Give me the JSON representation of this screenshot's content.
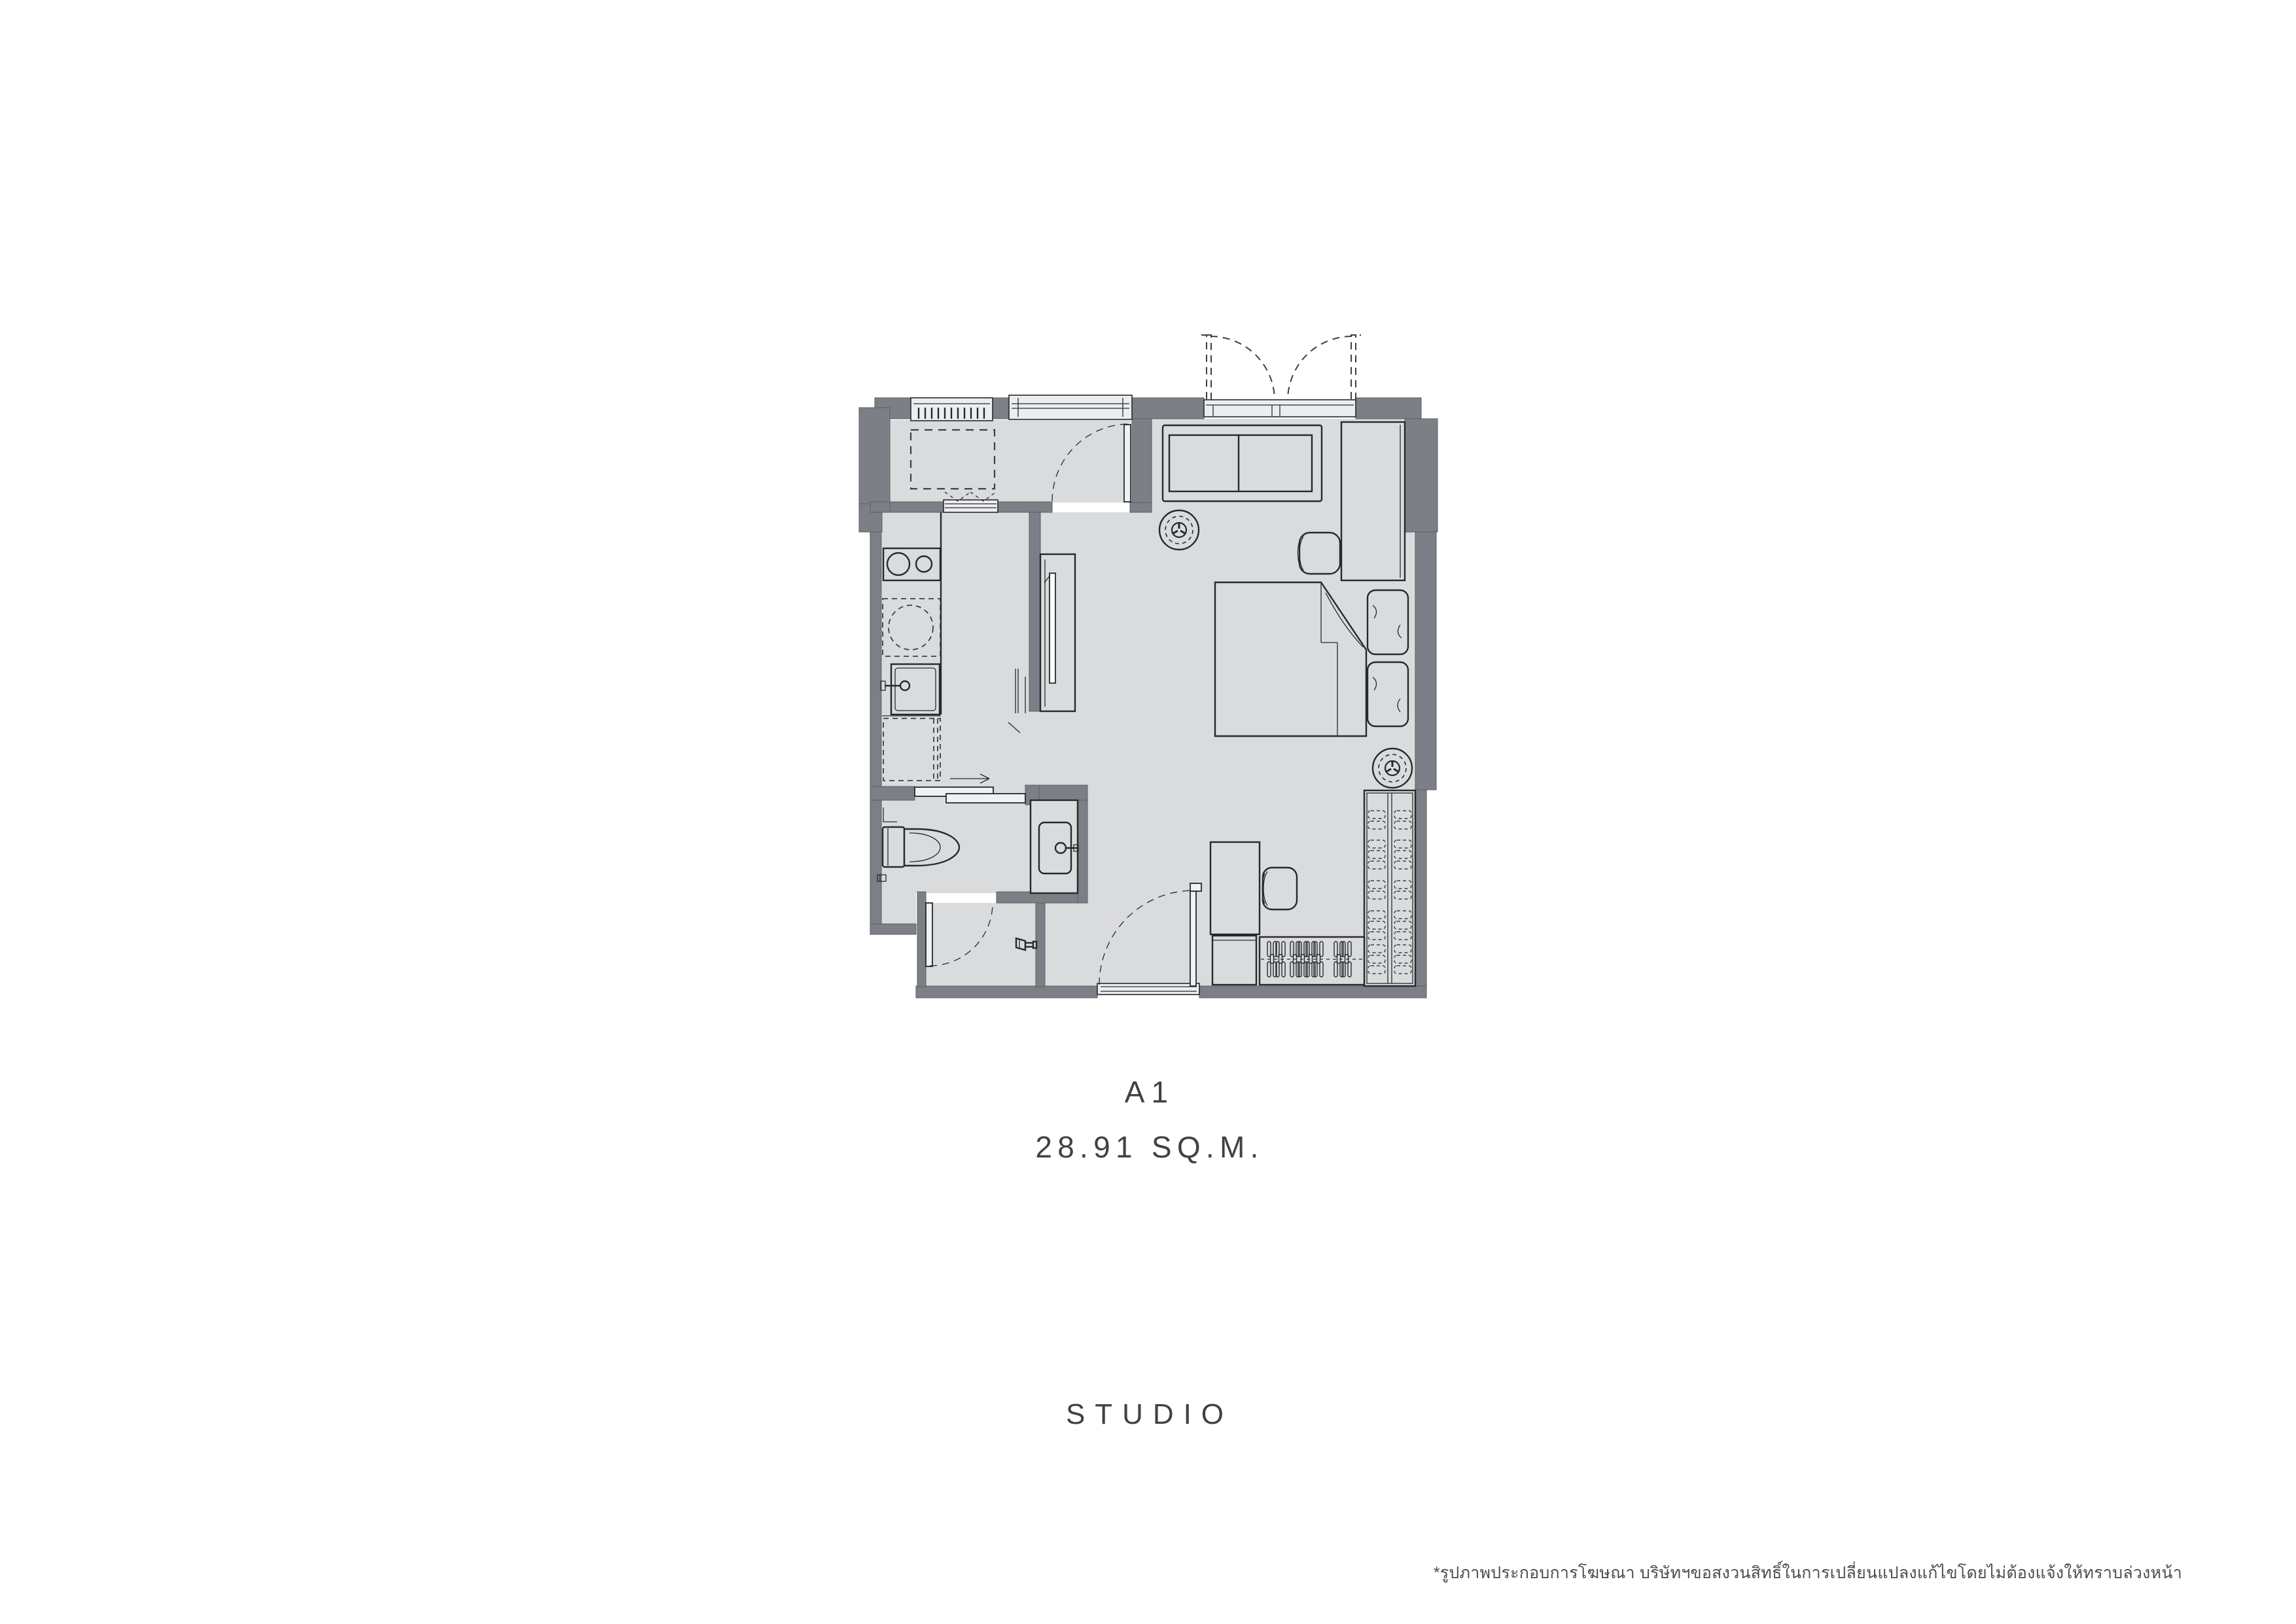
{
  "labels": {
    "unit": "A1",
    "area": "28.91 SQ.M.",
    "type": "STUDIO",
    "disclaimer": "*รูปภาพประกอบการโฆษณา บริษัทฯขอสงวนสิทธิ์ในการเปลี่ยนแปลงแก้ไขโดยไม่ต้องแจ้งให้ทราบล่วงหน้า"
  },
  "colors": {
    "background": "#ffffff",
    "wall": "#7c8086",
    "floor": "#dadbdd",
    "window": "#ecedee",
    "leaf": "#f0f1f2",
    "line": "#26292c",
    "dash": "#3c4043",
    "text": "#3f4245"
  },
  "rooms": [
    "balcony-ac-ledge",
    "living-sleeping-area",
    "kitchen-corridor",
    "bathroom",
    "shower-room",
    "entry-foyer",
    "wardrobe-corner"
  ],
  "fixtures": [
    "ac-condenser-louver-icon",
    "ac-unit-dashed-icon",
    "french-doors-icon",
    "sliding-window-icon",
    "balcony-door-icon",
    "sofa-icon",
    "round-stool-icon",
    "side-cabinet-icon",
    "lounge-chair-icon",
    "double-bed-icon",
    "pillow-icon",
    "tv-cabinet-icon",
    "cooktop-icon",
    "under-counter-washer-icon",
    "kitchen-sink-icon",
    "refrigerator-dashed-icon",
    "bathroom-sliding-door-icon",
    "toilet-icon",
    "vanity-sink-icon",
    "paper-holder-icon",
    "shower-sprayer-icon",
    "entry-door-icon",
    "desk-icon",
    "desk-chair-icon",
    "wardrobe-shelves-icon",
    "clothes-hanger-icon"
  ]
}
